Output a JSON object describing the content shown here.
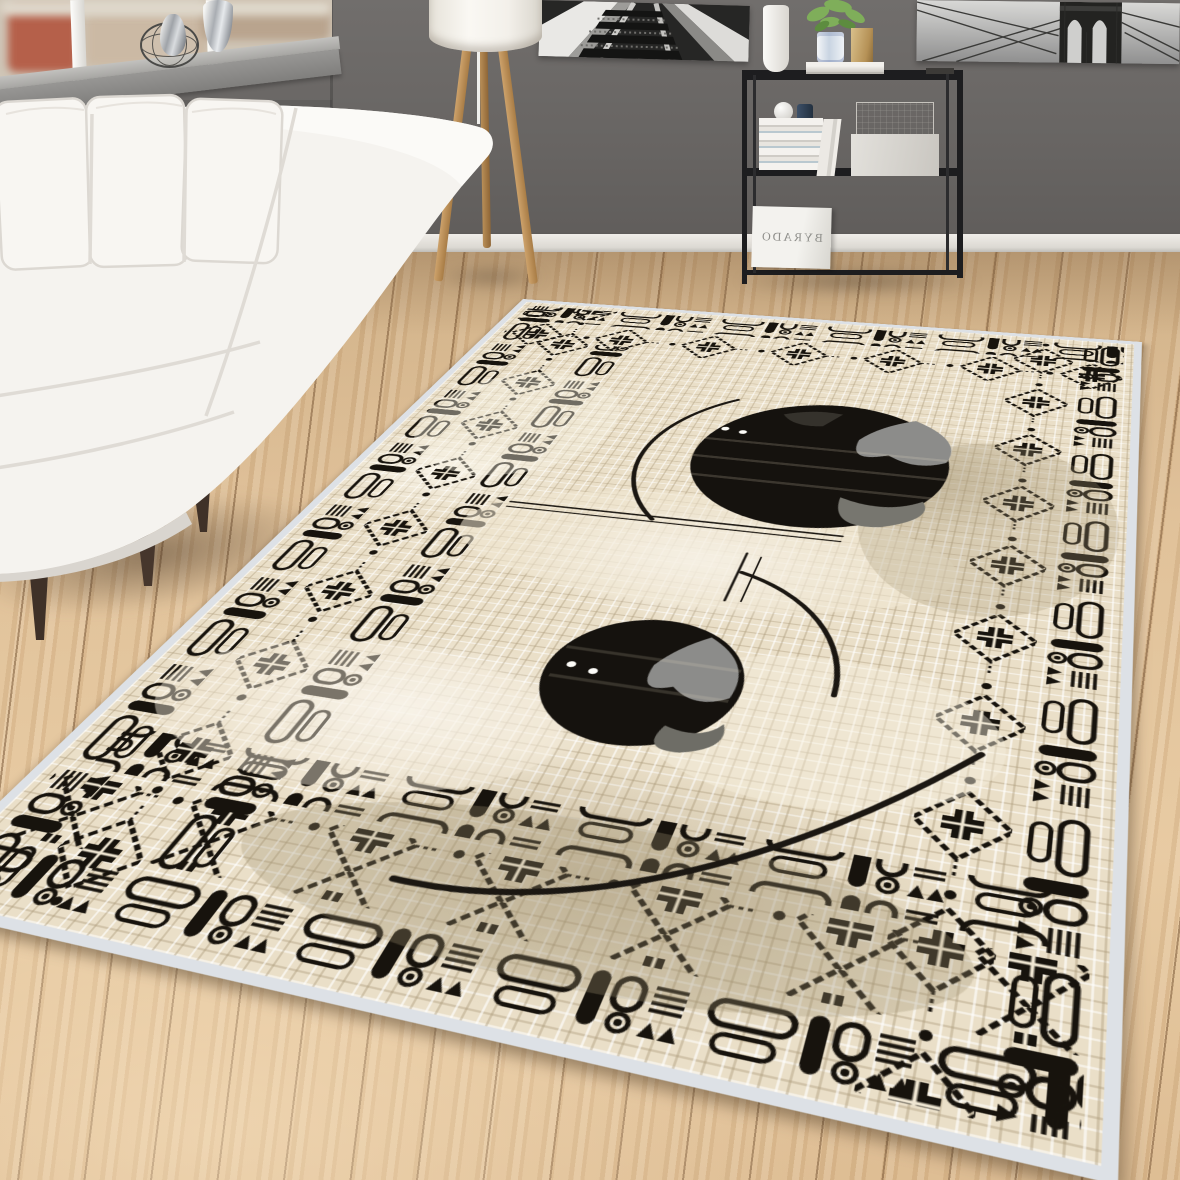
{
  "page": {
    "type": "product-photo",
    "subject": "ethnic bordered beige area rug staged in a modern living room"
  },
  "board": {
    "text": "BYRADO",
    "mirrored": true
  },
  "rug": {
    "field_color": "#eadfc8",
    "motif_color": "#17130d",
    "binding_color": "#dde1e6",
    "texture": "distressed crosshatch weave",
    "border_rows": [
      "capsule-doodle row",
      "stepped-diamond row"
    ],
    "center_circles": 2,
    "circle_color": "#15120e",
    "circle_patch_color": "#8c8c8a",
    "white_dots_per_circle": 2,
    "arc_strokes": 3
  },
  "room": {
    "wall_color": "#686563",
    "baseboard_color": "#eceae5",
    "floor_color": "#dfbf95",
    "sofa_color": "#f5f3ef",
    "sofa_pillows": 3,
    "lamp_style": "wood tripod floor lamp",
    "lamp_wood_color": "#c09761",
    "shelf_color": "#1d1d1f",
    "art_prints": [
      "railroad-tracks-bw",
      "brooklyn-bridge-bw"
    ],
    "window_view": "city buildings"
  }
}
